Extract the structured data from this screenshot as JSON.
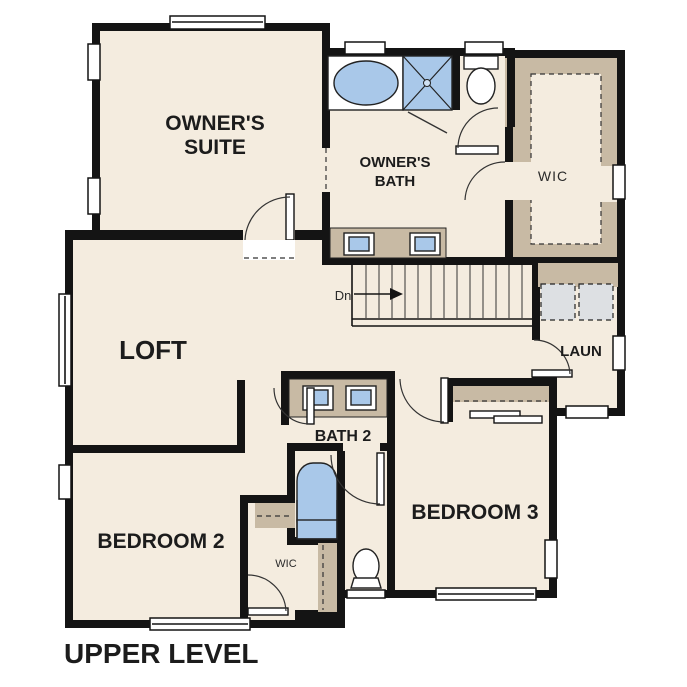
{
  "plan": {
    "title": "UPPER LEVEL",
    "rooms": {
      "owners_suite": {
        "line1": "OWNER'S",
        "line2": "SUITE"
      },
      "owners_bath": {
        "line1": "OWNER'S",
        "line2": "BATH"
      },
      "wic_owners": {
        "label": "WIC"
      },
      "loft": {
        "label": "LOFT"
      },
      "laundry": {
        "label": "LAUN"
      },
      "bath2": {
        "label": "BATH 2"
      },
      "bedroom2": {
        "label": "BEDROOM 2"
      },
      "wic_bedroom2": {
        "label": "WIC"
      },
      "bedroom3": {
        "label": "BEDROOM 3"
      }
    },
    "stairs": {
      "direction_label": "Dn"
    },
    "colors": {
      "floor": "#f4ecdf",
      "wall": "#141414",
      "casework": "#c8baa4",
      "fixture_blue": "#a9c8e9",
      "appliance_gray": "#dde0e3"
    },
    "fixture_icons": [
      "bathtub-icon",
      "shower-icon",
      "toilet-icon",
      "double-vanity-icon",
      "washer-dryer-icon",
      "staircase-icon"
    ]
  }
}
